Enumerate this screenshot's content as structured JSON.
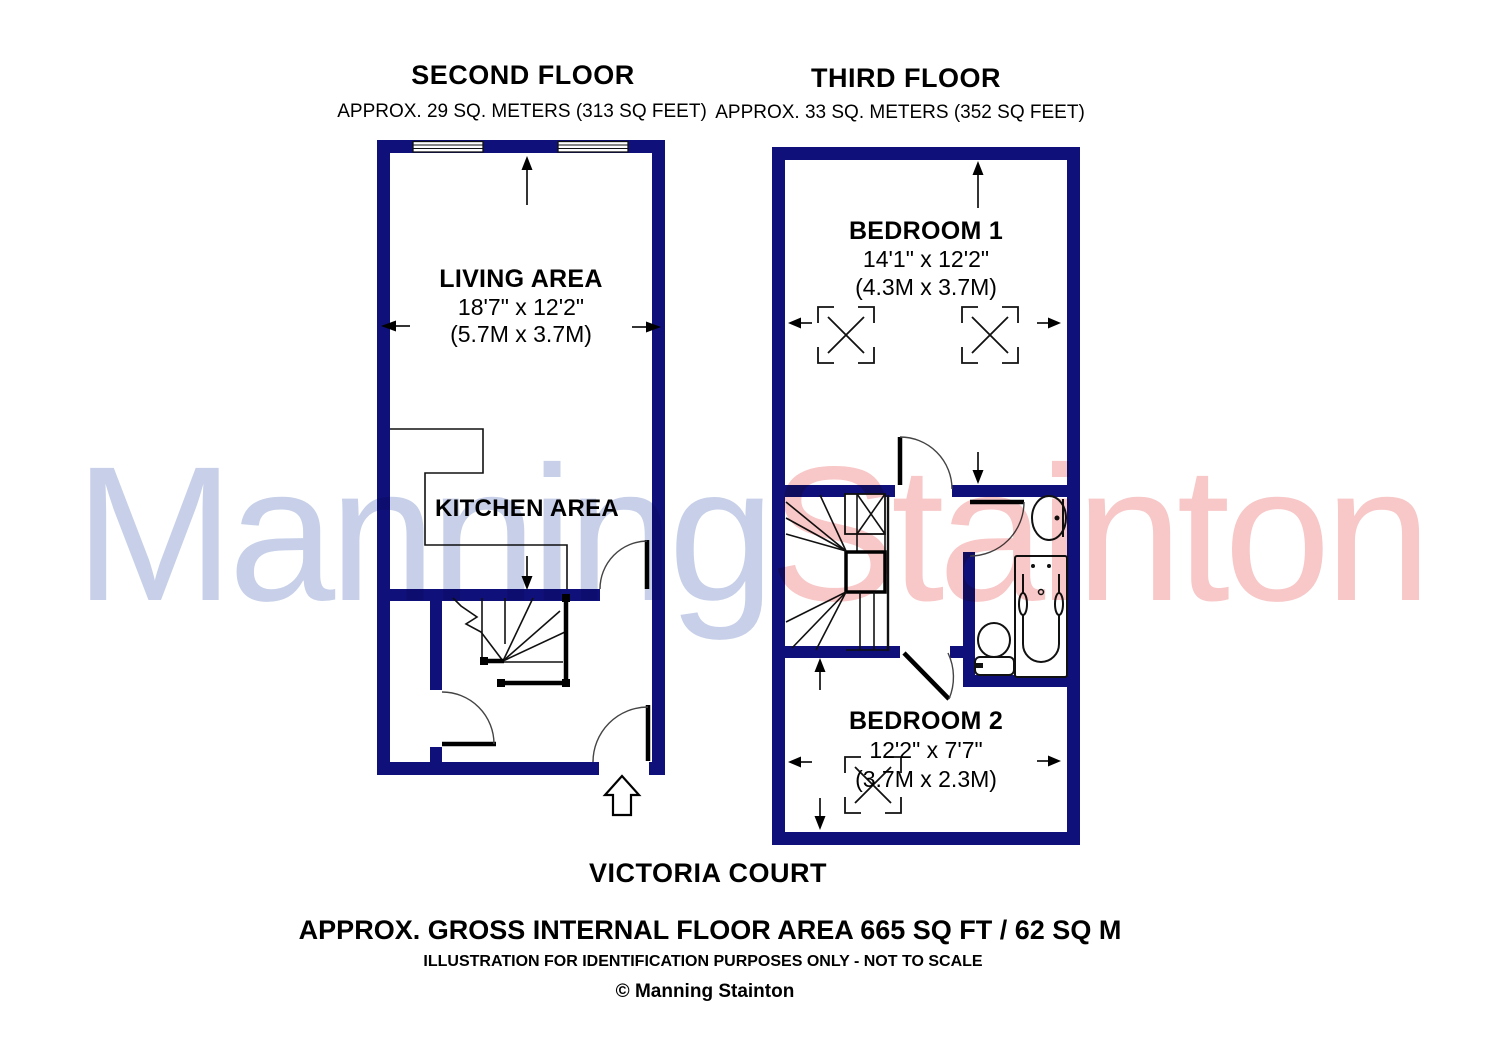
{
  "colors": {
    "wall": "#10107a",
    "watermark_manning": "#c7d0e8",
    "watermark_stainton": "#f8c7c7"
  },
  "watermark": {
    "part1": "Manning",
    "part2": "Stainton"
  },
  "floors": [
    {
      "title": "SECOND FLOOR",
      "subtitle": "APPROX. 29 SQ. METERS (313 SQ FEET)",
      "rooms": [
        {
          "name": "LIVING AREA",
          "dimensions_imperial": "18'7\" x 12'2\"",
          "dimensions_metric": "(5.7M x 3.7M)"
        },
        {
          "name": "KITCHEN AREA"
        }
      ]
    },
    {
      "title": "THIRD FLOOR",
      "subtitle": "APPROX. 33 SQ. METERS (352 SQ FEET)",
      "rooms": [
        {
          "name": "BEDROOM 1",
          "dimensions_imperial": "14'1\" x 12'2\"",
          "dimensions_metric": "(4.3M x 3.7M)"
        },
        {
          "name": "BEDROOM 2",
          "dimensions_imperial": "12'2\" x 7'7\"",
          "dimensions_metric": "(3.7M x 2.3M)"
        }
      ]
    }
  ],
  "footer": {
    "property_name": "VICTORIA COURT",
    "area_summary": "APPROX. GROSS INTERNAL FLOOR AREA 665 SQ FT / 62 SQ M",
    "disclaimer": "ILLUSTRATION FOR IDENTIFICATION PURPOSES ONLY - NOT TO SCALE",
    "copyright": "© Manning Stainton"
  }
}
